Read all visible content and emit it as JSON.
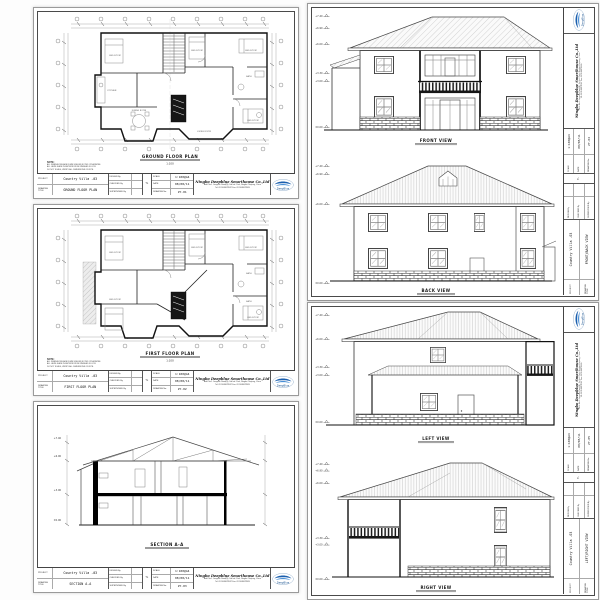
{
  "project_name": "Country Villa -03",
  "company": {
    "name": "Ningbo Deepblue Smarthouse Co.,Ltd",
    "address_line1": "Add: No.1 Jiangnan Road(N), 3rd Ind. Park, Ningbo Zhejiang, China",
    "address_line2": "Tel: 0574-88078587    Fax: 0574-88078589",
    "logo_text": "DeepBlue"
  },
  "titleblock_labels": {
    "project": "PROJECT",
    "drawing_title": "DRAWING TITLE",
    "design_by": "DESIGN By",
    "checked_by": "CHECKED By",
    "supervised_by": "SUPERVISED By",
    "tl": "TL",
    "scale": "SCALE",
    "date": "DATE",
    "drawing_no": "DRAWING No."
  },
  "sheets": [
    {
      "title": "GROUND FLOOR PLAN",
      "caption": "GROUND FLOOR PLAN",
      "caption_scale": "1:100",
      "scale": "1:100@A4",
      "date": "08/08/11",
      "no": "ZY-01"
    },
    {
      "title": "FIRST FLOOR PLAN",
      "caption": "FIRST FLOOR PLAN",
      "caption_scale": "1:100",
      "scale": "1:100@A4",
      "date": "08/08/11",
      "no": "ZY-02"
    },
    {
      "title": "SECTION A-A",
      "caption": "SECTION A-A",
      "caption_scale": "1:100",
      "scale": "1:100@A4",
      "date": "08/08/11",
      "no": "ZY-03"
    },
    {
      "title": "FRONT/BACK VIEW",
      "captions": [
        "FRONT VIEW",
        "BACK VIEW"
      ],
      "scale": "1:100@A4",
      "date": "08/08/11",
      "no": "ZY-04"
    },
    {
      "title": "LEFT/RIGHT VIEW",
      "captions": [
        "LEFT VIEW",
        "RIGHT VIEW"
      ],
      "scale": "1:100@A4",
      "date": "08/08/11",
      "no": "ZY-05"
    }
  ],
  "levels": {
    "front": [
      "+7.40",
      "+6.90",
      "+6.00",
      "+3.30",
      "+3.00",
      "±0.00"
    ],
    "back": [
      "+7.40",
      "+6.90",
      "+6.00",
      "±0.00"
    ],
    "left": [
      "+7.40",
      "+6.00",
      "+3.30",
      "+3.00",
      "±0.00"
    ],
    "right": [
      "+7.40",
      "+6.90",
      "+6.00",
      "+3.30",
      "+3.00",
      "±0.00"
    ],
    "section": [
      "+7.40",
      "+6.00",
      "+3.00",
      "±0.00"
    ]
  },
  "rooms": [
    "BED ROOM",
    "BED ROOM",
    "BED ROOM",
    "BED ROOM",
    "KITCHEN",
    "DINING ROOM",
    "LIVING ROOM",
    "BATH",
    "BATH"
  ],
  "note": {
    "label": "NOTE:",
    "lines": [
      "ALL DIMENSIONS ARE IN MM UNLESS NOTED OTHERWISE.",
      "ALL LEVELS ARE IN METERS FROM FINISHED FLOOR.",
      "DO NOT SCALE; VERIFY ALL DIMENSIONS ON SITE."
    ]
  }
}
